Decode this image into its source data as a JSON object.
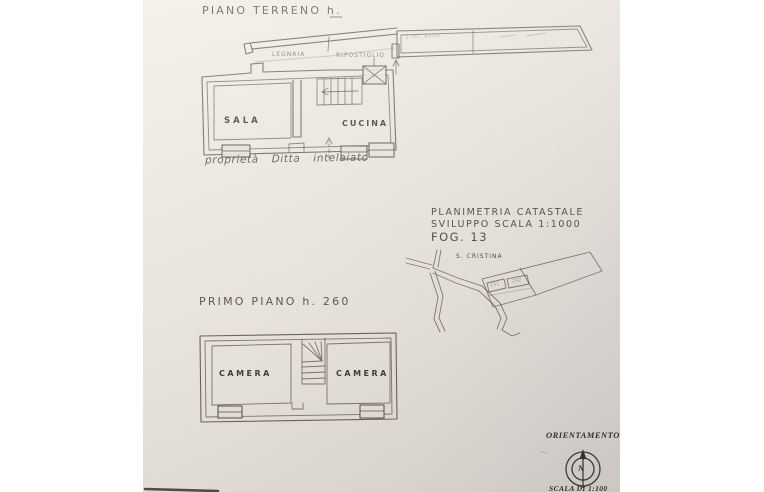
{
  "ground_floor": {
    "title": "PIANO TERRENO h.",
    "rooms": {
      "sala": "SALA",
      "cucina": "CUCINA"
    },
    "annex": {
      "legnaia": "LEGNAIA",
      "ripostiglio": "RIPOSTIGLIO",
      "note": "2 mt. bassi"
    },
    "caption": "proprietà Ditta intelaiato"
  },
  "cadastral": {
    "line1": "PLANIMETRIA CATASTALE",
    "line2": "SVILUPPO SCALA 1:1000",
    "line3": "FOG. 13",
    "map": {
      "locality": "S. CRISTINA",
      "parcel_left": "151",
      "parcel_right": "292"
    }
  },
  "first_floor": {
    "title": "PRIMO PIANO h. 260",
    "rooms": {
      "camera_left": "CAMERA",
      "camera_right": "CAMERA"
    }
  },
  "orientation": {
    "title": "ORIENTAMENTO",
    "north_letter": "N",
    "scale": "SCALA DI 1:100"
  },
  "colors": {
    "paper": "#e9e4dd",
    "ink": "#4a443c",
    "background": "#ffffff"
  }
}
